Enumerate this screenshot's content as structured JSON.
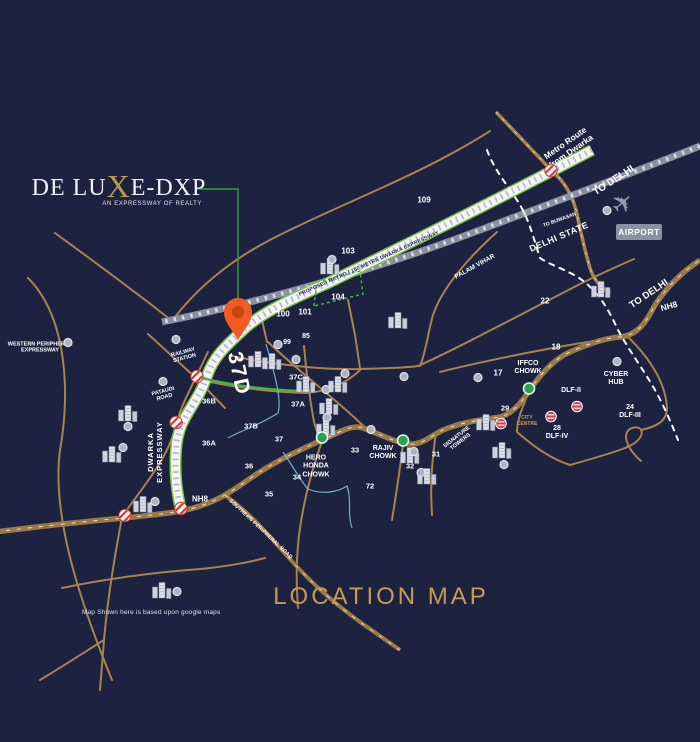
{
  "colors": {
    "background": "#1c2240",
    "road_tan": "#a8834d",
    "highway_tan": "#9c7a45",
    "expressway_green": "#7fc141",
    "expressway_white": "#f4f5f7",
    "railway_gray": "#8b90a0",
    "gold_text": "#c59d51",
    "pin_orange": "#f15a22",
    "chowk_green": "#2aa34f",
    "crossing_red": "#d23b33",
    "boundary_white": "#ffffff",
    "drain_blue": "#86d4ee"
  },
  "logo": {
    "title_pre": "DE LU",
    "title_x": "X",
    "title_post": "E-DXP",
    "tagline": "AN EXPRESSWAY OF REALTY"
  },
  "map_title": "LOCATION MAP",
  "disclaimer": "Map Shown here is based upon google maps",
  "airport": {
    "label": "AIRPORT",
    "plane_icon": "airplane"
  },
  "labels": [
    {
      "name": "metro-route-from-dwarka",
      "text": "Metro Route\nfrom Dwarka",
      "x": 568,
      "y": 147,
      "rot": -35,
      "fs": 8.5,
      "w": 700
    },
    {
      "name": "to-delhi-top",
      "text": "TO DELHI",
      "x": 614,
      "y": 181,
      "rot": -33,
      "fs": 10,
      "w": 700
    },
    {
      "name": "to-bijwasan",
      "text": "TO BIJWASAN",
      "x": 560,
      "y": 221,
      "rot": -20,
      "fs": 5,
      "w": 700
    },
    {
      "name": "delhi-state",
      "text": "DELHI STATE",
      "x": 559,
      "y": 237,
      "rot": -23,
      "fs": 9,
      "w": 600,
      "ls": 0.5
    },
    {
      "name": "palam-vihar",
      "text": "PALAM VIHAR",
      "x": 475,
      "y": 267,
      "rot": -29,
      "fs": 6.5,
      "w": 700
    },
    {
      "name": "to-delhi-right",
      "text": "TO DELHI",
      "x": 649,
      "y": 294,
      "rot": -34,
      "fs": 9.5,
      "w": 700
    },
    {
      "name": "nh8-right",
      "text": "NH8",
      "x": 669,
      "y": 306,
      "rot": -15,
      "fs": 8.5,
      "w": 700
    },
    {
      "name": "proposed-metro-expressway",
      "text": "PROPOSED METRO / 150 METRE DWARKA EXPRESSWAY",
      "x": 369,
      "y": 264,
      "rot": -24,
      "fs": 5.2,
      "w": 700,
      "color": "#252b52",
      "ls": 0.2
    },
    {
      "name": "sector-109",
      "text": "109",
      "x": 424,
      "y": 200,
      "fs": 8,
      "w": 600
    },
    {
      "name": "sector-103",
      "text": "103",
      "x": 348,
      "y": 251,
      "fs": 8,
      "w": 600
    },
    {
      "name": "sector-104",
      "text": "104",
      "x": 338,
      "y": 297,
      "fs": 8,
      "w": 600
    },
    {
      "name": "sector-101",
      "text": "101",
      "x": 305,
      "y": 312,
      "fs": 8,
      "w": 600
    },
    {
      "name": "sector-100",
      "text": "100",
      "x": 283,
      "y": 314,
      "fs": 8,
      "w": 600
    },
    {
      "name": "sector-99",
      "text": "99",
      "x": 287,
      "y": 343,
      "fs": 7,
      "w": 600
    },
    {
      "name": "sector-85",
      "text": "85",
      "x": 306,
      "y": 337,
      "fs": 7,
      "w": 600
    },
    {
      "name": "sector-22",
      "text": "22",
      "x": 545,
      "y": 301,
      "fs": 8,
      "w": 600
    },
    {
      "name": "sector-18",
      "text": "18",
      "x": 556,
      "y": 347,
      "fs": 8,
      "w": 600
    },
    {
      "name": "sector-17",
      "text": "17",
      "x": 498,
      "y": 373,
      "fs": 8,
      "w": 600
    },
    {
      "name": "western-peripheral-expressway",
      "text": "WESTERN PERIPHERAL\nEXPRESSWAY",
      "x": 40,
      "y": 348,
      "fs": 5.5,
      "w": 700
    },
    {
      "name": "railway-station",
      "text": "RAILWAY\nSTATION",
      "x": 184,
      "y": 356,
      "rot": -15,
      "fs": 5.5,
      "w": 700
    },
    {
      "name": "pataudi-road",
      "text": "PATAUDI\nROAD",
      "x": 164,
      "y": 395,
      "rot": -15,
      "fs": 5.5,
      "w": 700
    },
    {
      "name": "dwarka-expressway",
      "text": "DWARKA\nEXPRESSWAY",
      "x": 156,
      "y": 452,
      "rot": -90,
      "fs": 7.5,
      "w": 700,
      "ls": 1
    },
    {
      "name": "sector-37d",
      "text": "37D",
      "x": 238,
      "y": 374,
      "rot": 78,
      "fs": 21,
      "w": 700,
      "ls": 2
    },
    {
      "name": "sector-36b",
      "text": "36B",
      "x": 209,
      "y": 402,
      "fs": 7.5,
      "w": 600
    },
    {
      "name": "sector-37b",
      "text": "37B",
      "x": 251,
      "y": 427,
      "fs": 7.5,
      "w": 600
    },
    {
      "name": "sector-36a",
      "text": "36A",
      "x": 209,
      "y": 444,
      "fs": 7.5,
      "w": 600
    },
    {
      "name": "sector-37",
      "text": "37",
      "x": 279,
      "y": 440,
      "fs": 7.5,
      "w": 600
    },
    {
      "name": "sector-36",
      "text": "36",
      "x": 249,
      "y": 467,
      "fs": 7.5,
      "w": 600
    },
    {
      "name": "sector-35",
      "text": "35",
      "x": 269,
      "y": 495,
      "fs": 7.5,
      "w": 600
    },
    {
      "name": "sector-34",
      "text": "34",
      "x": 297,
      "y": 478,
      "fs": 7.5,
      "w": 600
    },
    {
      "name": "nh8-left",
      "text": "NH8",
      "x": 200,
      "y": 499,
      "fs": 8,
      "w": 700
    },
    {
      "name": "sector-37c",
      "text": "37C",
      "x": 296,
      "y": 378,
      "fs": 7.5,
      "w": 600
    },
    {
      "name": "sector-37a",
      "text": "37A",
      "x": 298,
      "y": 405,
      "fs": 7.5,
      "w": 600
    },
    {
      "name": "hero-honda-chowk",
      "text": "HERO\nHONDA\nCHOWK",
      "x": 316,
      "y": 467,
      "fs": 7,
      "w": 700
    },
    {
      "name": "sector-33",
      "text": "33",
      "x": 355,
      "y": 451,
      "fs": 7.5,
      "w": 600
    },
    {
      "name": "sector-72",
      "text": "72",
      "x": 370,
      "y": 487,
      "fs": 7.5,
      "w": 600
    },
    {
      "name": "rajiv-chowk",
      "text": "RAJIV\nCHOWK",
      "x": 383,
      "y": 453,
      "fs": 7,
      "w": 700
    },
    {
      "name": "sector-32",
      "text": "32",
      "x": 410,
      "y": 467,
      "fs": 7.5,
      "w": 600
    },
    {
      "name": "sector-31",
      "text": "31",
      "x": 436,
      "y": 455,
      "fs": 7.5,
      "w": 600
    },
    {
      "name": "signature-towers",
      "text": "SIGNATURE\nTOWERS",
      "x": 459,
      "y": 440,
      "rot": -38,
      "fs": 5.5,
      "w": 700
    },
    {
      "name": "iffco-chowk",
      "text": "IFFCO\nCHOWK",
      "x": 528,
      "y": 368,
      "fs": 7,
      "w": 700
    },
    {
      "name": "cyber-hub",
      "text": "CYBER\nHUB",
      "x": 616,
      "y": 379,
      "fs": 7,
      "w": 700
    },
    {
      "name": "dlf-2",
      "text": "DLF-II",
      "x": 571,
      "y": 391,
      "fs": 7,
      "w": 700
    },
    {
      "name": "dlf-3",
      "text": "24\nDLF-III",
      "x": 630,
      "y": 412,
      "fs": 7,
      "w": 600
    },
    {
      "name": "sector-29",
      "text": "29",
      "x": 505,
      "y": 409,
      "fs": 7.5,
      "w": 600
    },
    {
      "name": "city-centre",
      "text": "CITY\nCENTRE",
      "x": 527,
      "y": 422,
      "fs": 5,
      "w": 700,
      "color": "#c59d51"
    },
    {
      "name": "dlf-4",
      "text": "28\nDLF-IV",
      "x": 557,
      "y": 433,
      "fs": 7,
      "w": 600
    },
    {
      "name": "southern-peripheral-road",
      "text": "SOUTHERN PERIPHERAL ROAD",
      "x": 260,
      "y": 530,
      "rot": 43,
      "fs": 5,
      "w": 600,
      "ls": 0.3
    }
  ],
  "icons": {
    "buildings": [
      [
        330,
        268
      ],
      [
        258,
        361
      ],
      [
        272,
        363
      ],
      [
        306,
        386
      ],
      [
        338,
        386
      ],
      [
        329,
        408
      ],
      [
        326,
        429
      ],
      [
        398,
        322
      ],
      [
        410,
        457
      ],
      [
        427,
        478
      ],
      [
        502,
        452
      ],
      [
        601,
        291
      ],
      [
        128,
        415
      ],
      [
        112,
        456
      ],
      [
        143,
        506
      ],
      [
        162,
        592
      ],
      [
        486,
        424
      ]
    ],
    "dots": [
      [
        332,
        261
      ],
      [
        278,
        346
      ],
      [
        296,
        361
      ],
      [
        345,
        375
      ],
      [
        326,
        391
      ],
      [
        404,
        378
      ],
      [
        478,
        379
      ],
      [
        327,
        419
      ],
      [
        371,
        431
      ],
      [
        414,
        453
      ],
      [
        421,
        474
      ],
      [
        504,
        466
      ],
      [
        68,
        344
      ],
      [
        176,
        341
      ],
      [
        163,
        383
      ],
      [
        128,
        428
      ],
      [
        123,
        449
      ],
      [
        155,
        503
      ],
      [
        177,
        593
      ],
      [
        617,
        363
      ],
      [
        607,
        212
      ]
    ],
    "chowks": [
      [
        322,
        440
      ],
      [
        403,
        443
      ],
      [
        529,
        391
      ]
    ],
    "crossings": [
      [
        551,
        173
      ],
      [
        197,
        379
      ],
      [
        176,
        425
      ],
      [
        181,
        511
      ],
      [
        125,
        518
      ]
    ],
    "metro_stations": [
      [
        501,
        426
      ],
      [
        551,
        419
      ],
      [
        577,
        409
      ]
    ]
  }
}
